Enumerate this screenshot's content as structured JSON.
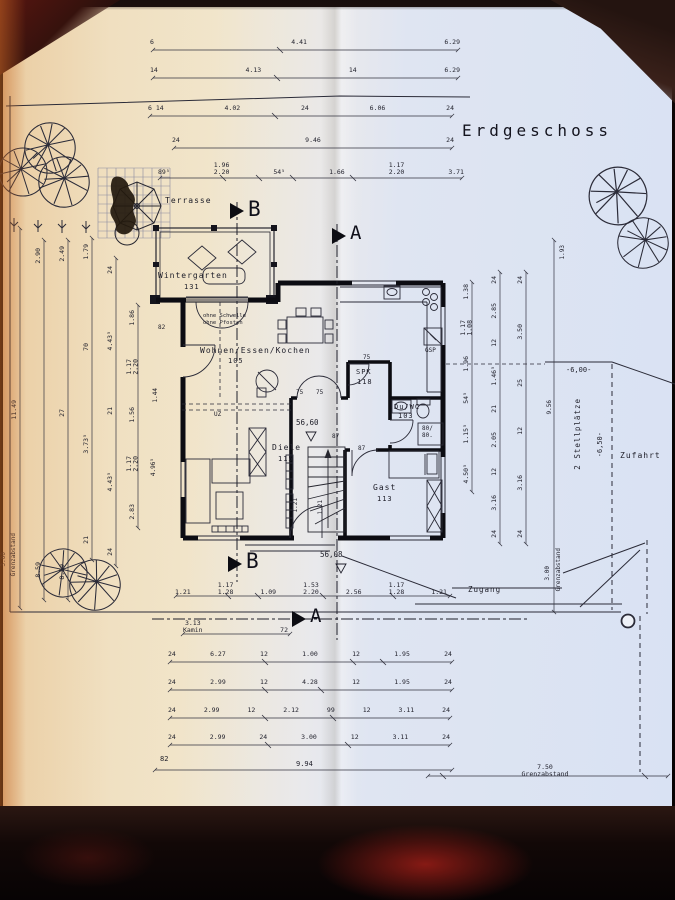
{
  "title": "Erdgeschoss",
  "sections": {
    "b": "B",
    "a": "A"
  },
  "rooms": {
    "terrasse": {
      "name": "Terrasse"
    },
    "wintergarten": {
      "name": "Wintergarten",
      "area": "131"
    },
    "wohnen": {
      "name": "Wohnen/Essen/Kochen",
      "area": "105"
    },
    "spk": {
      "name": "SPK",
      "area": "118"
    },
    "duwc": {
      "name": "Du/WC",
      "area": "103"
    },
    "diele": {
      "name": "Diele",
      "area": "115"
    },
    "gast": {
      "name": "Gast",
      "area": "113"
    }
  },
  "labels": {
    "note": "ohne Schwelle\nohne Pfosten",
    "gsp": "GSP",
    "uz": "UZ",
    "shower": "80/\n80.",
    "elev1": "56,60",
    "elev2": "56,08",
    "door75_spk": "75",
    "door75_l": "75",
    "door75_r": "75",
    "d87a": "87",
    "d87b": "87",
    "d121a": "1.21",
    "d121b": "1.21",
    "d82_wall": "82",
    "d144": "1.44",
    "d496": "4.96⁵",
    "d193": "1.93",
    "d956": "9.56",
    "d82_bottom": "82",
    "d994": "9.94",
    "zugang": "Zugang",
    "zufahrt": "Zufahrt",
    "stellplaetze": "2 Stellplätze",
    "level_a": "-6,00-",
    "level_b": "-6,50-",
    "grenz_left_val": "3.00",
    "grenz_left": "Grenzabstand",
    "grenz_right_val": "3.00",
    "grenz_right": "Grenzabstand",
    "grenz_bottom": "7.50\nGrenzabstand"
  },
  "dims": {
    "t1": [
      "6",
      "4.41",
      "6.29"
    ],
    "t2": [
      "14",
      "4.13",
      "14",
      "6.29"
    ],
    "t3": [
      "6 14",
      "4.02",
      "24",
      "6.06",
      "24"
    ],
    "t4": [
      "24",
      "9.46",
      "24"
    ],
    "t5": [
      "89⁵",
      "1.96\n2.20",
      "54⁵",
      "1.66",
      "1.17\n2.20",
      "3.71"
    ],
    "b1": [
      "1.21",
      "1.17\n1.28",
      "1.09",
      "1.53\n2.20",
      "2.56",
      "1.17\n1.28",
      "1.21"
    ],
    "b2": [
      "3.13\nKamin",
      "72"
    ],
    "b3": [
      "24",
      "6.27",
      "12",
      "1.00",
      "12",
      "1.95",
      "24"
    ],
    "b4": [
      "24",
      "2.99",
      "12",
      "4.28",
      "12",
      "1.95",
      "24"
    ],
    "b5": [
      "24",
      "2.99",
      "12",
      "2.12",
      "99",
      "12",
      "3.11",
      "24"
    ],
    "b6": [
      "24",
      "2.99",
      "24",
      "3.00",
      "12",
      "3.11",
      "24"
    ],
    "l1": [
      "11.49"
    ],
    "l2": [
      "2.90",
      "8.59"
    ],
    "l3": [
      "2.49",
      "27",
      "8.59"
    ],
    "l4": [
      "1.79",
      "70",
      "3.73⁵",
      "21"
    ],
    "l5": [
      "24",
      "4.43⁵",
      "21",
      "4.43⁵",
      "24"
    ],
    "l6": [
      "1.86",
      "1.17\n2.20",
      "1.56",
      "1.17\n2.20",
      "2.83"
    ],
    "r1": [
      "1.38",
      "1.17\n1.08",
      "1.96",
      "54⁵",
      "1.15⁵",
      "4.50⁵"
    ],
    "r2": [
      "24",
      "2.85",
      "12",
      "1.46⁵",
      "21",
      "2.05",
      "12",
      "3.16",
      "24"
    ],
    "r3": [
      "24",
      "3.50",
      "25",
      "12",
      "3.16",
      "24"
    ]
  }
}
